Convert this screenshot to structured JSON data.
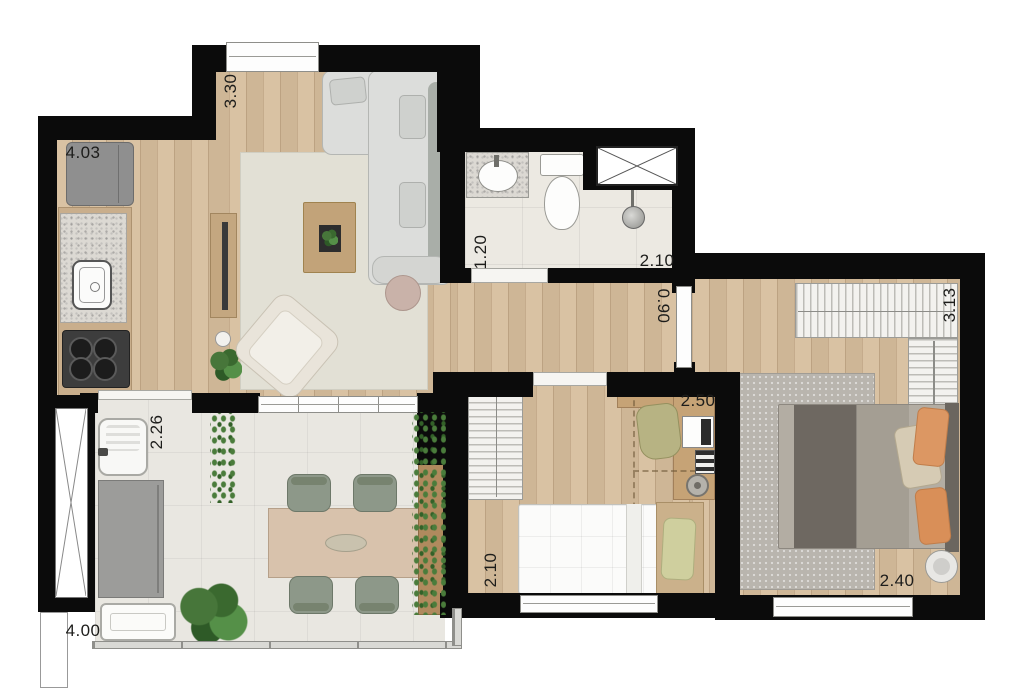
{
  "floor_plan": {
    "type": "apartment-top-view-render",
    "dimensions": [
      {
        "value": "4.03",
        "area": "kitchen",
        "orientation": "horizontal"
      },
      {
        "value": "3.30",
        "area": "living-room",
        "orientation": "vertical"
      },
      {
        "value": "1.20",
        "area": "bathroom",
        "orientation": "vertical"
      },
      {
        "value": "2.10",
        "area": "bathroom",
        "orientation": "horizontal"
      },
      {
        "value": "0.90",
        "area": "hallway",
        "orientation": "vertical"
      },
      {
        "value": "2.50",
        "area": "bedroom-2",
        "orientation": "horizontal"
      },
      {
        "value": "2.10",
        "area": "bedroom-2",
        "orientation": "vertical"
      },
      {
        "value": "3.13",
        "area": "master-bedroom",
        "orientation": "vertical"
      },
      {
        "value": "2.40",
        "area": "master-bedroom",
        "orientation": "horizontal"
      },
      {
        "value": "2.26",
        "area": "balcony",
        "orientation": "vertical"
      },
      {
        "value": "4.00",
        "area": "balcony",
        "orientation": "horizontal"
      }
    ],
    "colors": {
      "wall": "#0b0b0b",
      "wood_floor": "#d6bd9c",
      "tile_floor": "#ecE9e2",
      "rug_living": "#e2e0d5",
      "rug_master": "#b9b5ae",
      "sofa": "#dcdddb",
      "accent_pillow_orange": "#dc9763",
      "plant_green": "#47763a"
    }
  }
}
